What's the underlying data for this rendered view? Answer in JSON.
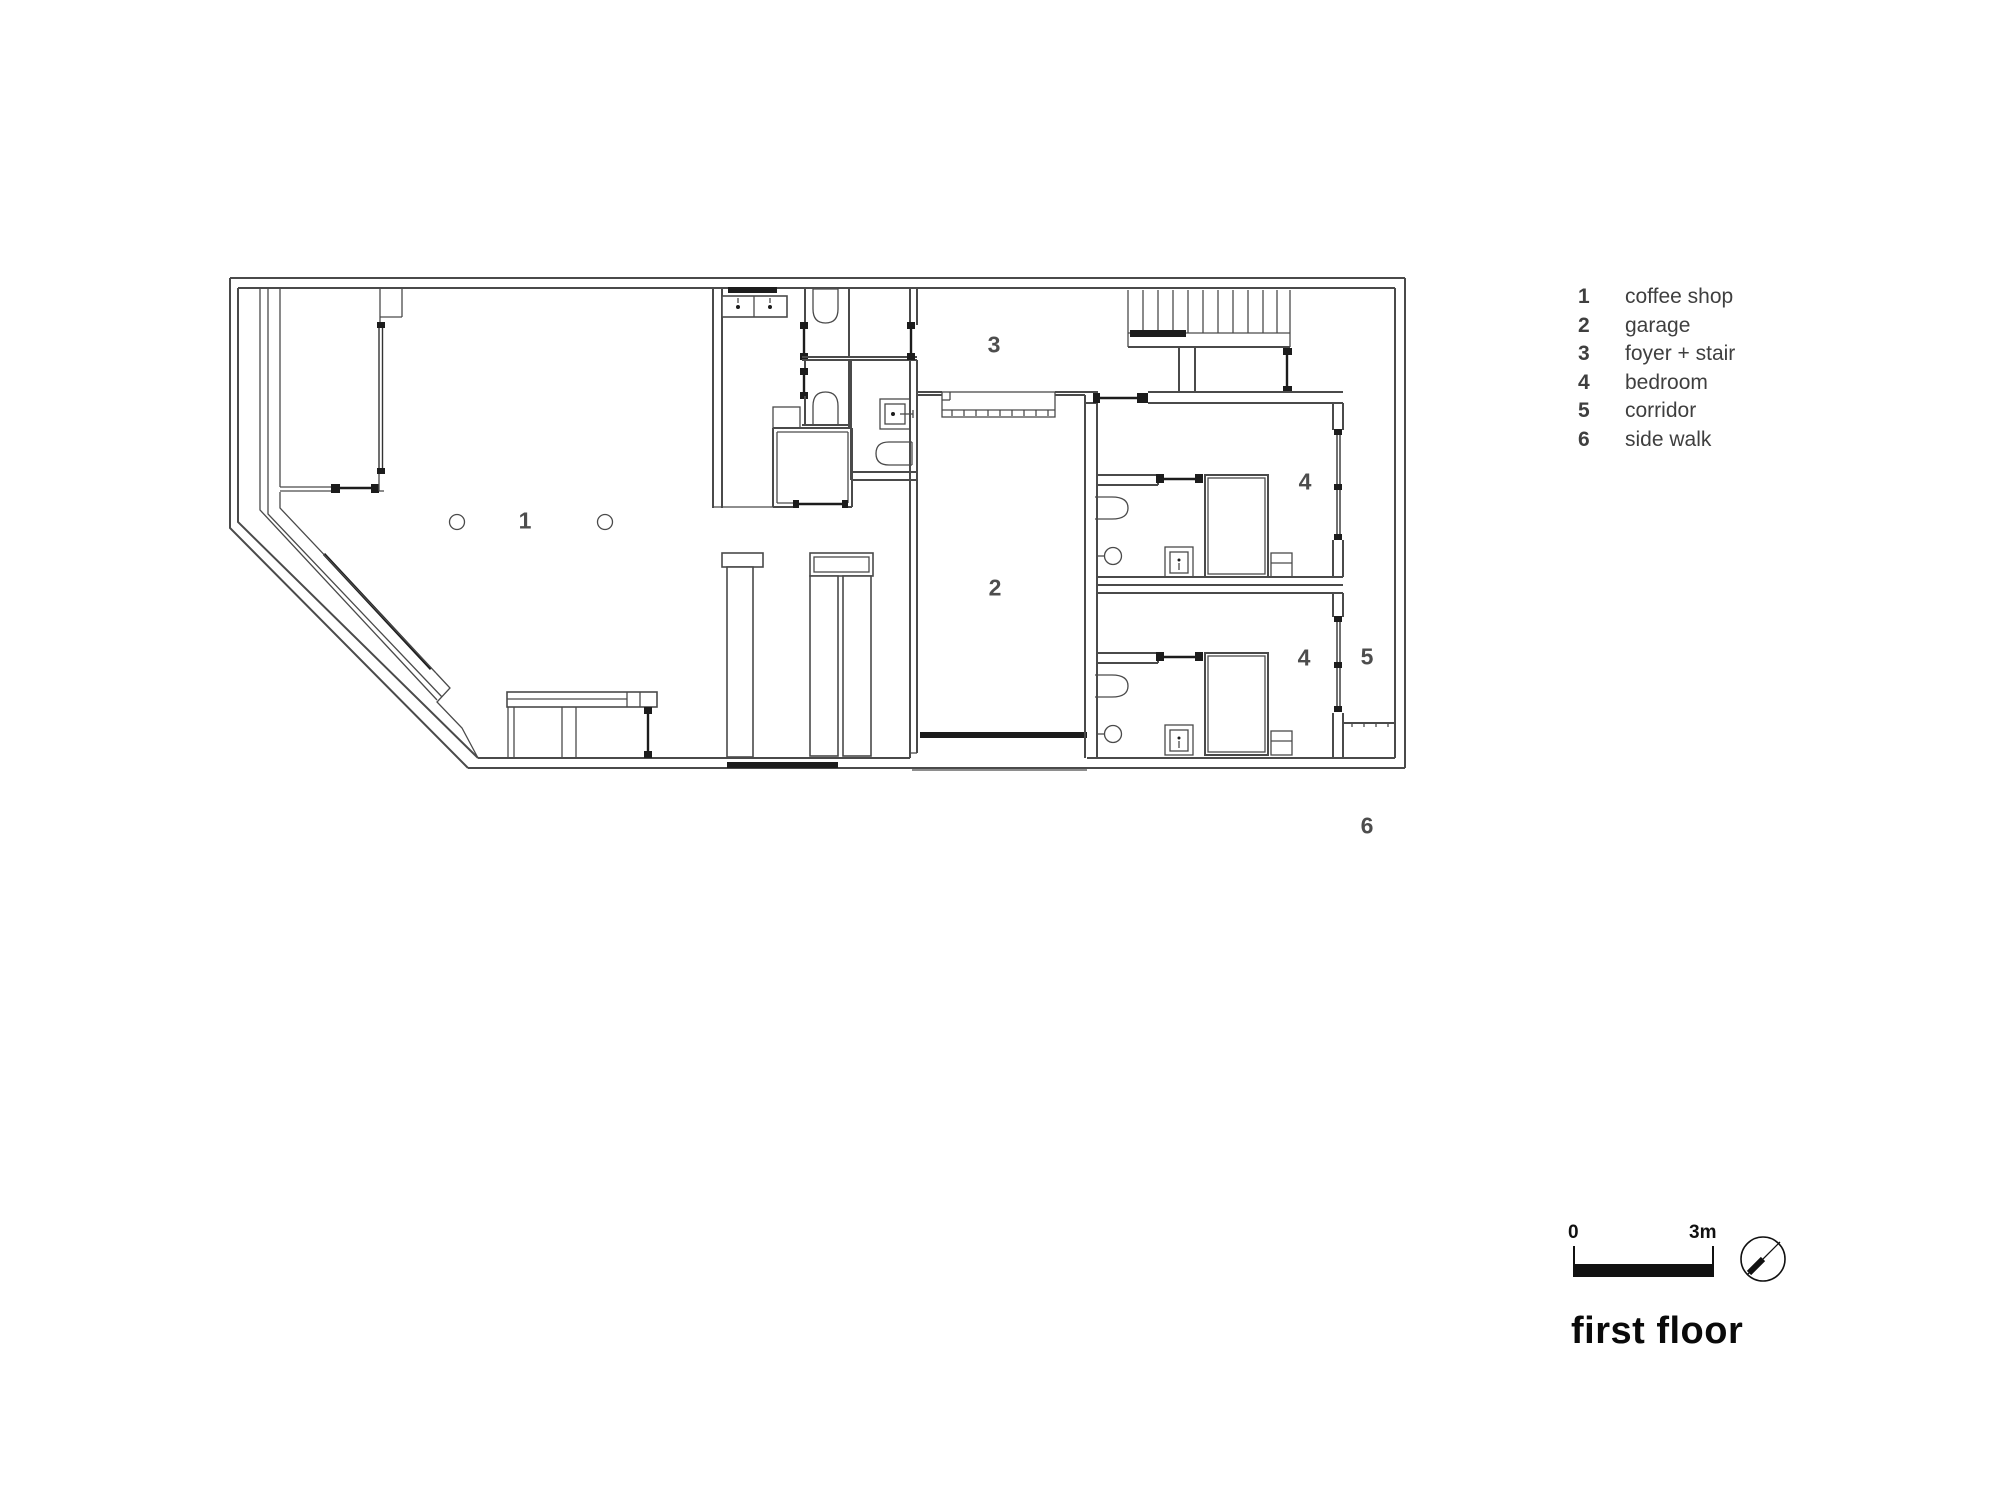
{
  "title": {
    "text": "first floor"
  },
  "scale": {
    "start": "0",
    "end": "3m"
  },
  "legend": {
    "items": [
      {
        "num": "1",
        "label": "coffee shop"
      },
      {
        "num": "2",
        "label": "garage"
      },
      {
        "num": "3",
        "label": "foyer + stair"
      },
      {
        "num": "4",
        "label": "bedroom"
      },
      {
        "num": "5",
        "label": "corridor"
      },
      {
        "num": "6",
        "label": "side walk"
      }
    ]
  },
  "plan_labels": {
    "coffee_shop": "1",
    "garage": "2",
    "foyer_stair": "3",
    "bedroom_upper": "4",
    "bedroom_lower": "4",
    "corridor": "5",
    "side_walk": "6"
  },
  "colors": {
    "line": "#4a4a4a",
    "dark": "#1c1c1c",
    "label": "#4d4d4d",
    "title": "#0a0a0a",
    "bg": "#ffffff"
  }
}
